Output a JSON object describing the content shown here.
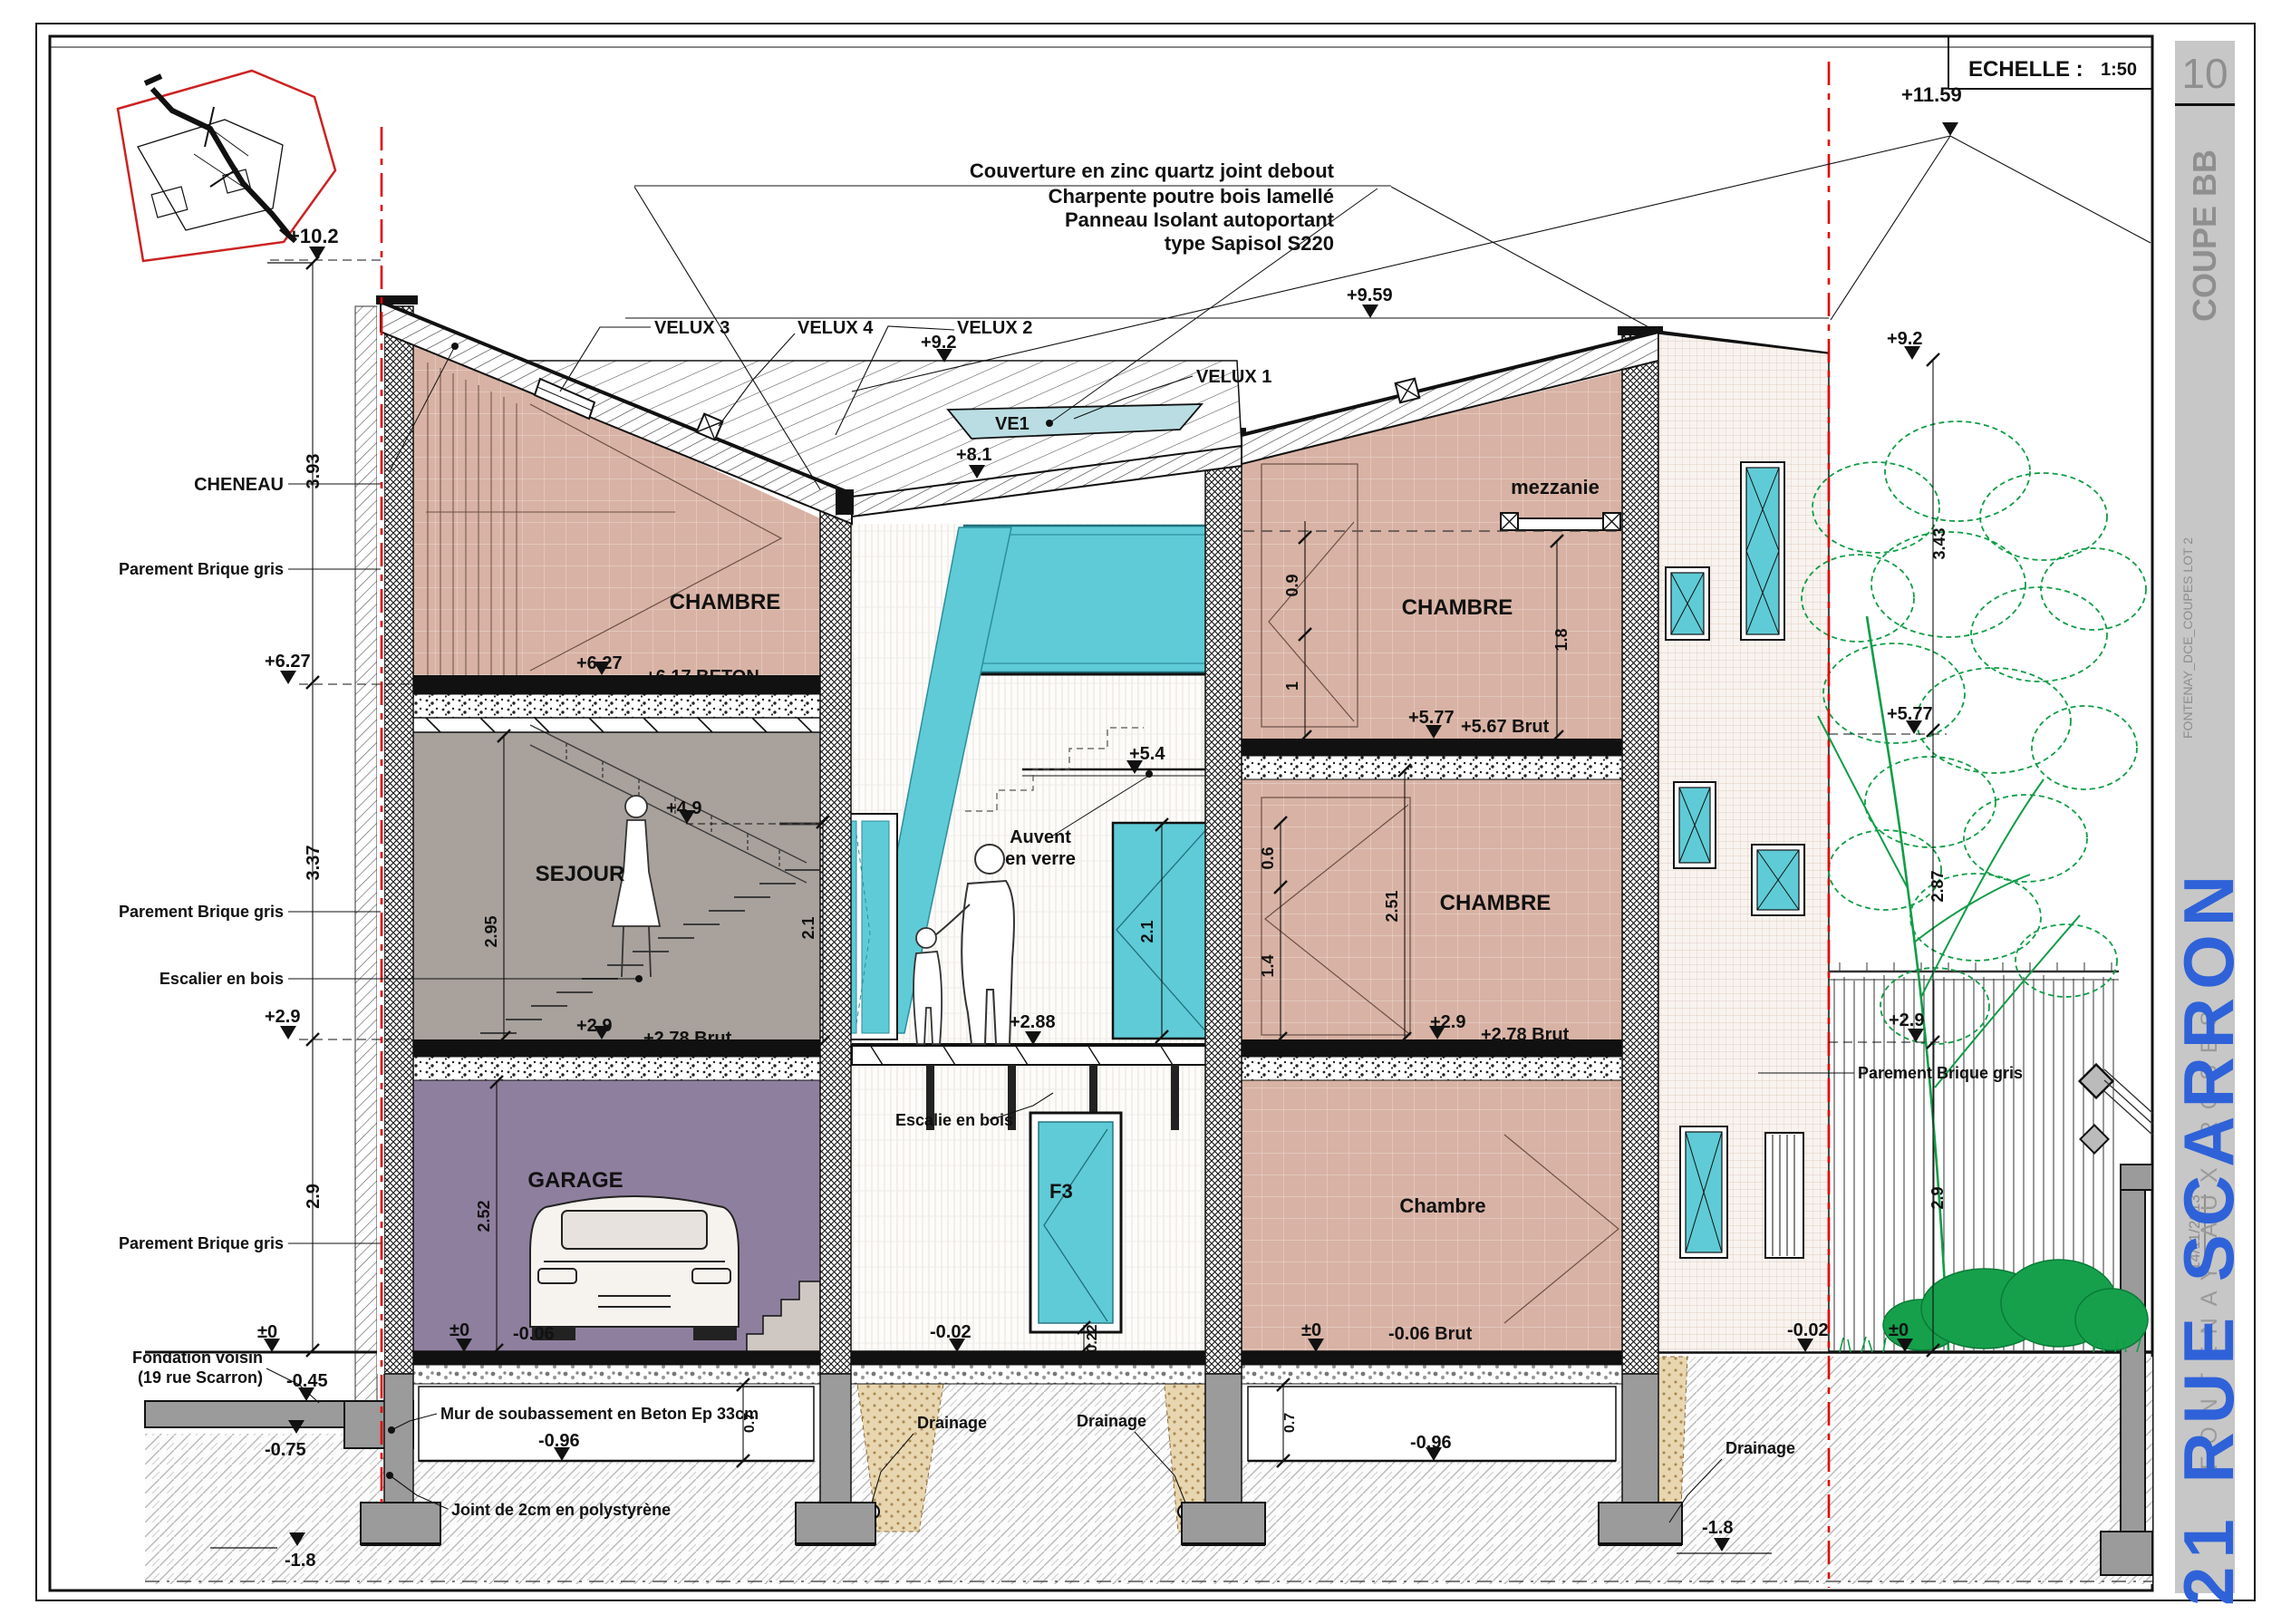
{
  "palette": {
    "red_line": "#e10000",
    "cyan_glass": "#5fcbd6",
    "rose_room": "#d8b2a4",
    "purple_room": "#8f7f9e",
    "grey_room": "#a8a19c",
    "tree_green": "#0f9d46",
    "title_blue": "#2f62d8",
    "band_grey": "#c7c7c7"
  },
  "scalebox": {
    "label": "ECHELLE :",
    "value": "1:50"
  },
  "sidebar": {
    "number": "10",
    "title": "COUPE BB",
    "file": "FONTENAY_DCE_COUPES LOT 2",
    "date": "14/11/2013",
    "street": "21 RUE SCARRON",
    "city": "FONTENAY AUX ROSES"
  },
  "roof_note": {
    "line1": "Couverture en zinc quartz joint debout",
    "line2": "Charpente poutre bois lamellé",
    "line3": "Panneau Isolant autoportant",
    "line4": "type Sapisol S220"
  },
  "velux": {
    "v3": "VELUX 3",
    "v4": "VELUX 4",
    "v2": "VELUX 2",
    "v1": "VELUX 1",
    "ve1": "VE1"
  },
  "levels": {
    "p11_59": "+11.59",
    "p10_2": "+10.2",
    "p9_59": "+9.59",
    "p9_2_mid": "+9.2",
    "p9_2_right": "+9.2",
    "p8_1": "+8.1",
    "p6_27_margin": "+6.27",
    "p6_27": "+6.27",
    "p6_17": "+6.17 BETON",
    "p5_77": "+5.77",
    "p5_67": "+5.67 Brut",
    "p5_77_right": "+5.77",
    "p5_4": "+5.4",
    "p4_9": "+4.9",
    "p2_9_margin": "+2.9",
    "p2_9_left": "+2.9",
    "p2_78_left": "+2.78 Brut",
    "p2_88": "+2.88",
    "p2_9_r": "+2.9",
    "p2_78_r": "+2.78 Brut",
    "p2_9_far": "+2.9",
    "z_neighbor": "±0",
    "z_garage": "±0",
    "m006": "-0.06",
    "z_right": "±0",
    "m006brut": "-0.06 Brut",
    "z_garden": "±0",
    "m002_mid": "-0.02",
    "m002_r": "-0.02",
    "m045": "-0.45",
    "m075": "-0.75",
    "m096_l": "-0.96",
    "m096_r": "-0.96",
    "m18_l": "-1.8",
    "m18_r": "-1.8"
  },
  "dims": {
    "d393": "3.93",
    "d337": "3.37",
    "d29l": "2.9",
    "d295": "2.95",
    "d252": "2.52",
    "d21s": "2.1",
    "d21w": "2.1",
    "d09": "0.9",
    "d1": "1",
    "d18": "1.8",
    "d06": "0.6",
    "d14": "1.4",
    "d251": "2.51",
    "d343": "3.43",
    "d287": "2.87",
    "d29r": "2.9",
    "d07l": "0.7",
    "d07r": "0.7",
    "d022": "0.22"
  },
  "rooms": {
    "chambre_tl": "CHAMBRE",
    "sejour": "SEJOUR",
    "garage": "GARAGE",
    "mezzanine": "mezzanie",
    "chambre_tr": "CHAMBRE",
    "chambre_mr": "CHAMBRE",
    "chambre_br": "Chambre",
    "f3": "F3",
    "auvent1": "Auvent",
    "auvent2": "en verre"
  },
  "callouts": {
    "cheneau": "CHENEAU",
    "parement": "Parement Brique gris",
    "escalier": "Escalier en bois",
    "escalie": "Escalie en bois",
    "fondation1": "Fondation voisin",
    "fondation2": "(19 rue Scarron)",
    "mur": "Mur de soubassement en Beton Ep 33cm",
    "joint": "Joint de 2cm en polystyrène",
    "drainage": "Drainage"
  }
}
